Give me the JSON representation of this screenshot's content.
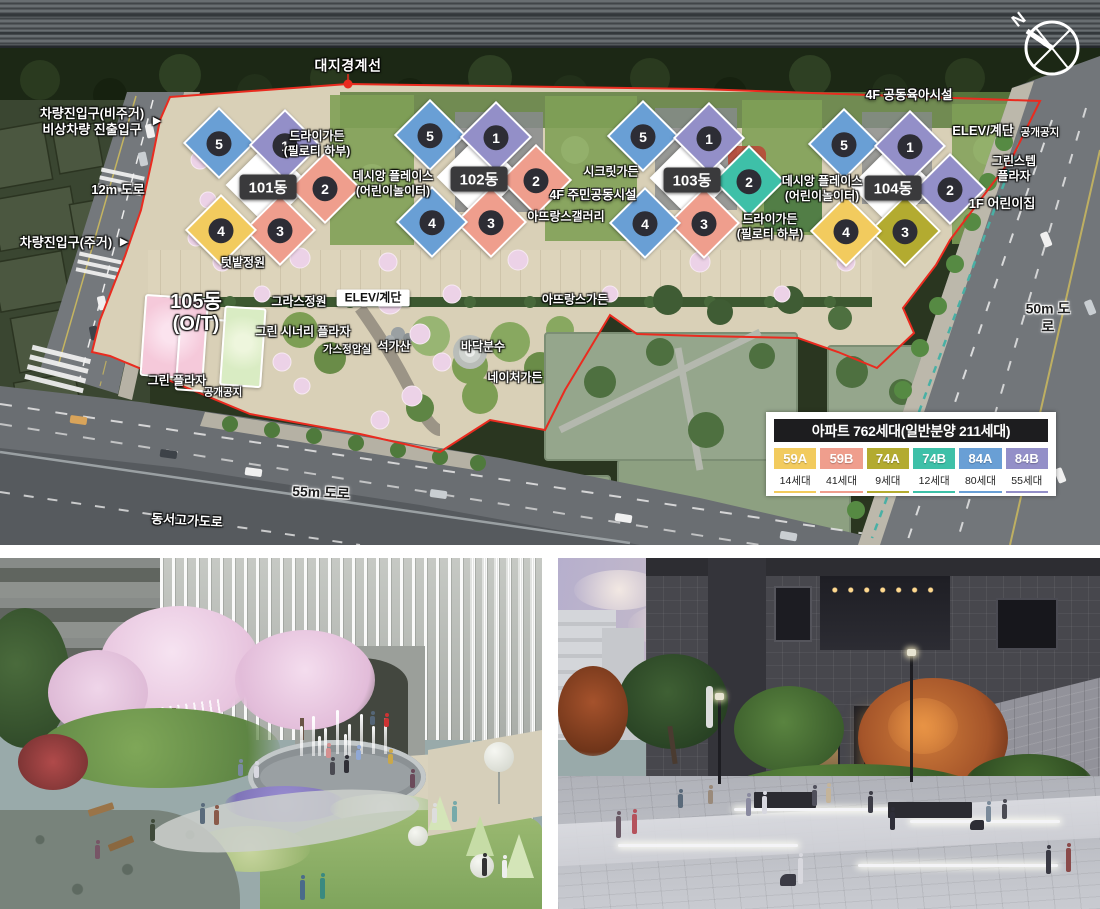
{
  "site_plan": {
    "compass_n": "N",
    "legend": {
      "title": "아파트 762세대(일반분양 211세대)",
      "items": [
        {
          "type": "59A",
          "count": "14세대",
          "color": "#f2cb5e"
        },
        {
          "type": "59B",
          "count": "41세대",
          "color": "#ef9e8d"
        },
        {
          "type": "74A",
          "count": "9세대",
          "color": "#b3ab30"
        },
        {
          "type": "74B",
          "count": "12세대",
          "color": "#3ec0a8"
        },
        {
          "type": "84A",
          "count": "80세대",
          "color": "#699fd5"
        },
        {
          "type": "84B",
          "count": "55세대",
          "color": "#938fc8"
        }
      ]
    },
    "buildings": [
      {
        "name": "101동",
        "cx": 268,
        "cy": 187,
        "units": [
          {
            "no": "5",
            "type": "84A"
          },
          {
            "no": "1",
            "type": "84B"
          },
          {
            "no": "2",
            "type": "59B"
          },
          {
            "no": "3",
            "type": "59B"
          },
          {
            "no": "4",
            "type": "59A"
          }
        ]
      },
      {
        "name": "102동",
        "cx": 479,
        "cy": 179,
        "units": [
          {
            "no": "5",
            "type": "84A"
          },
          {
            "no": "1",
            "type": "84B"
          },
          {
            "no": "2",
            "type": "59B"
          },
          {
            "no": "3",
            "type": "59B"
          },
          {
            "no": "4",
            "type": "84A"
          }
        ]
      },
      {
        "name": "103동",
        "cx": 692,
        "cy": 180,
        "units": [
          {
            "no": "5",
            "type": "84A"
          },
          {
            "no": "1",
            "type": "84B"
          },
          {
            "no": "2",
            "type": "74B"
          },
          {
            "no": "3",
            "type": "59B"
          },
          {
            "no": "4",
            "type": "84A"
          }
        ]
      },
      {
        "name": "104동",
        "cx": 893,
        "cy": 188,
        "units": [
          {
            "no": "5",
            "type": "84A"
          },
          {
            "no": "1",
            "type": "84B"
          },
          {
            "no": "2",
            "type": "84B"
          },
          {
            "no": "3",
            "type": "74A"
          },
          {
            "no": "4",
            "type": "59A"
          }
        ]
      }
    ],
    "labels": [
      {
        "id": "boundary-line-label",
        "text": "대지경계선",
        "x": 348,
        "y": 66,
        "cls": "w-lg"
      },
      {
        "id": "vehicle-entry-nonres-label",
        "text": "차량진입구(비주거)\n비상차량 진출입구",
        "x": 92,
        "y": 122,
        "cls": "w-md"
      },
      {
        "id": "vehicle-entry-nonres-arrow",
        "text": "▶",
        "x": 157,
        "y": 122,
        "cls": "arr"
      },
      {
        "id": "road-12m-label",
        "text": "12m 도로",
        "x": 118,
        "y": 190,
        "cls": "w-md"
      },
      {
        "id": "vehicle-entry-res-label",
        "text": "차량진입구(주거)",
        "x": 66,
        "y": 243,
        "cls": "w-md"
      },
      {
        "id": "vehicle-entry-res-arrow",
        "text": "▶",
        "x": 124,
        "y": 243,
        "cls": "arr"
      },
      {
        "id": "dry-garden-1-label",
        "text": "드라이가든\n(필로티 하부)",
        "x": 317,
        "y": 144,
        "cls": ""
      },
      {
        "id": "desian-place-1-label",
        "text": "데시앙 플레이스\n(어린이놀이터)",
        "x": 393,
        "y": 184,
        "cls": ""
      },
      {
        "id": "secret-garden-label",
        "text": "시크릿가든",
        "x": 611,
        "y": 172,
        "cls": ""
      },
      {
        "id": "community-4f-label",
        "text": "4F 주민공동시설",
        "x": 593,
        "y": 196,
        "cls": "strong"
      },
      {
        "id": "atelier-gallery-label",
        "text": "아뜨랑스갤러리",
        "x": 566,
        "y": 217,
        "cls": ""
      },
      {
        "id": "desian-place-2-label",
        "text": "데시앙 플레이스\n(어린이놀이터)",
        "x": 822,
        "y": 189,
        "cls": ""
      },
      {
        "id": "dry-garden-2-label",
        "text": "드라이가든\n(필로티 하부)",
        "x": 770,
        "y": 227,
        "cls": ""
      },
      {
        "id": "daycare-4f-label",
        "text": "4F 공동육아시설",
        "x": 909,
        "y": 96,
        "cls": "strong"
      },
      {
        "id": "elev-stairs-1-label",
        "text": "ELEV/계단",
        "x": 983,
        "y": 131,
        "cls": "w-md"
      },
      {
        "id": "open-space-1-label",
        "text": "공개공지",
        "x": 1040,
        "y": 133,
        "cls": "w-sm"
      },
      {
        "id": "greenstep-plaza-label",
        "text": "그린스텝\n플라자",
        "x": 1014,
        "y": 169,
        "cls": ""
      },
      {
        "id": "childcare-1f-label",
        "text": "1F 어린이집",
        "x": 1002,
        "y": 204,
        "cls": "w-md"
      },
      {
        "id": "vegetable-garden-label",
        "text": "텃밭정원",
        "x": 243,
        "y": 263,
        "cls": ""
      },
      {
        "id": "building-105-label",
        "text": "105동\n(O/T)",
        "x": 196,
        "y": 313,
        "cls": "w-xl"
      },
      {
        "id": "grass-garden-label",
        "text": "그라스정원",
        "x": 299,
        "y": 302,
        "cls": ""
      },
      {
        "id": "elev-stairs-2-label",
        "text": "ELEV/계단",
        "x": 373,
        "y": 298,
        "cls": "boxw"
      },
      {
        "id": "green-scenery-plaza-label",
        "text": "그린 시너리 플라자",
        "x": 303,
        "y": 332,
        "cls": ""
      },
      {
        "id": "gas-station-label",
        "text": "가스정압실",
        "x": 347,
        "y": 350,
        "cls": "w-sm"
      },
      {
        "id": "rock-mountain-label",
        "text": "석가산",
        "x": 394,
        "y": 347,
        "cls": ""
      },
      {
        "id": "floor-fountain-label",
        "text": "바닥분수",
        "x": 483,
        "y": 347,
        "cls": ""
      },
      {
        "id": "atelier-garden-label",
        "text": "아뜨랑스가든",
        "x": 575,
        "y": 300,
        "cls": ""
      },
      {
        "id": "nature-garden-label",
        "text": "네이처가든",
        "x": 515,
        "y": 378,
        "cls": ""
      },
      {
        "id": "green-plaza-label",
        "text": "그린 플라자",
        "x": 177,
        "y": 381,
        "cls": ""
      },
      {
        "id": "open-space-2-label",
        "text": "공개공지",
        "x": 223,
        "y": 393,
        "cls": "w-sm"
      },
      {
        "id": "road-50m-label",
        "text": "50m 도로",
        "x": 1048,
        "y": 318,
        "cls": "dk"
      },
      {
        "id": "road-55m-label",
        "text": "55m 도로",
        "x": 321,
        "y": 493,
        "cls": "dk",
        "rot": 3
      },
      {
        "id": "highway-label",
        "text": "동서고가도로",
        "x": 187,
        "y": 521,
        "cls": "w-md",
        "rot": 3
      }
    ]
  }
}
